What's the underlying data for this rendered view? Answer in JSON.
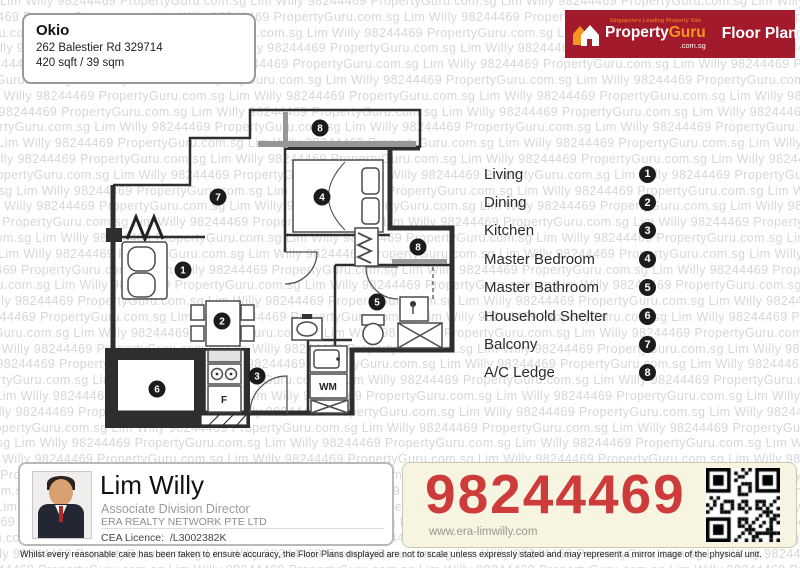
{
  "project": {
    "name": "Okio",
    "address": "262 Balestier Rd 329714",
    "area": "420 sqft / 39 sqm"
  },
  "brand": {
    "tagline": "Singapore's Leading Property Site",
    "name_left": "Property",
    "name_right": "Guru",
    "domain": ".com.sg",
    "product": "Floor Plans"
  },
  "legend": {
    "items": [
      {
        "label": "Living",
        "num": "1"
      },
      {
        "label": "Dining",
        "num": "2"
      },
      {
        "label": "Kitchen",
        "num": "3"
      },
      {
        "label": "Master Bedroom",
        "num": "4"
      },
      {
        "label": "Master Bathroom",
        "num": "5"
      },
      {
        "label": "Household Shelter",
        "num": "6"
      },
      {
        "label": "Balcony",
        "num": "7"
      },
      {
        "label": "A/C Ledge",
        "num": "8"
      }
    ]
  },
  "floorplan": {
    "wm_label": "WM",
    "fridge_label": "F"
  },
  "watermark": {
    "text": "Lim Willy 98244469 PropertyGuru.com.sg"
  },
  "footer": {
    "agent": {
      "name": "Lim Willy",
      "title": "Associate Division Director",
      "company": "ERA REALTY NETWORK PTE LTD",
      "licence_label": "CEA Licence:",
      "licence_value": "/L3002382K"
    },
    "contact": {
      "phone": "98244469",
      "website": "www.era-limwilly.com"
    },
    "disclaimer": "Whilst every reasonable care has been taken to ensure accuracy, the Floor Plans displayed are not to scale unless expressly stated and may represent a mirror image of the physical unit."
  },
  "colors": {
    "banner_red": "#A21A2B",
    "accent_orange": "#F7941E",
    "phone_red": "#CE3B3B",
    "phone_bg": "#F7F4E2",
    "watermark_gray": "#D5D7D9",
    "wall_dark": "#2E2E2E"
  }
}
